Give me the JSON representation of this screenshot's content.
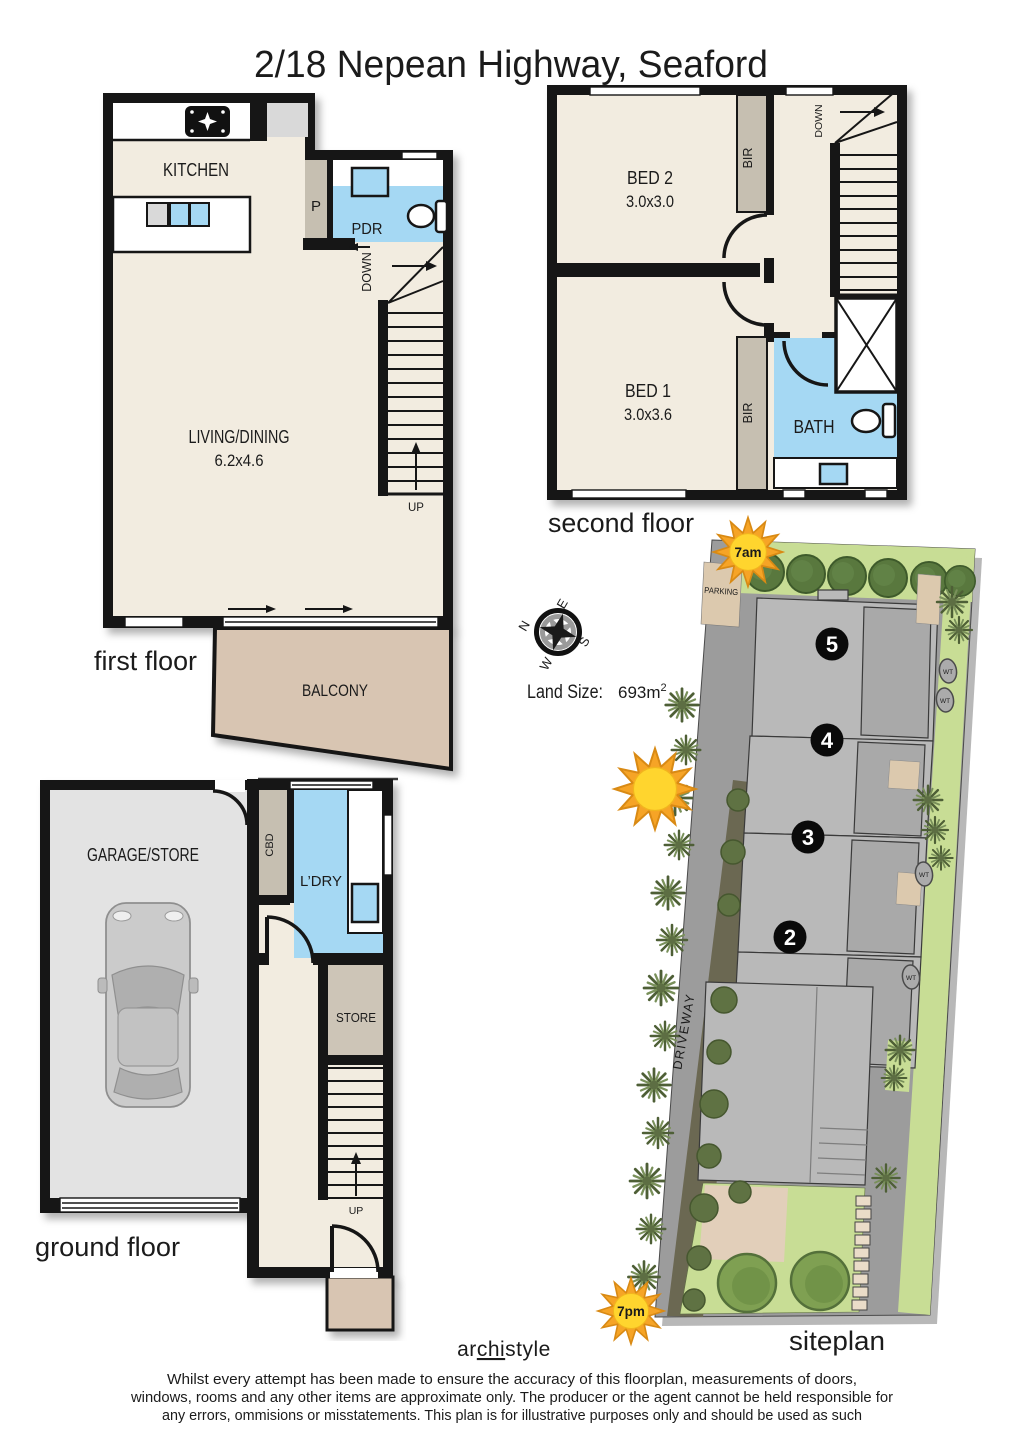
{
  "title": "2/18 Nepean Highway, Seaford",
  "floors": {
    "first": {
      "label": "first floor",
      "kitchen": "KITCHEN",
      "pantry": "P",
      "pdr": "PDR",
      "down": "DOWN",
      "up": "UP",
      "living": "LIVING/DINING",
      "living_dim": "6.2x4.6",
      "balcony": "BALCONY"
    },
    "second": {
      "label": "second floor",
      "bed2": "BED 2",
      "bed2_dim": "3.0x3.0",
      "bed1": "BED 1",
      "bed1_dim": "3.0x3.6",
      "bir": "BIR",
      "bath": "BATH",
      "down": "DOWN"
    },
    "ground": {
      "label": "ground floor",
      "garage": "GARAGE/STORE",
      "cbd": "CBD",
      "laundry": "L’DRY",
      "store": "STORE",
      "up": "UP"
    }
  },
  "siteplan": {
    "label": "siteplan",
    "parking": "PARKING",
    "driveway": "DRIVEWAY",
    "land_size_label": "Land Size:",
    "land_size_value": "693m",
    "land_size_sup": "2",
    "units": [
      "5",
      "4",
      "3",
      "2"
    ],
    "water_tank": "WT",
    "sun_morning": "7am",
    "sun_evening": "7pm",
    "compass": {
      "n": "N",
      "e": "E",
      "s": "S",
      "w": "W"
    }
  },
  "footer": {
    "logo_pre": "ar",
    "logo_mid": "chi",
    "logo_post": "style",
    "disclaimer1": "Whilst every attempt has been made to ensure the accuracy of this floorplan, measurements of doors,",
    "disclaimer2": "windows, rooms and any other items are approximate only. The producer or the agent cannot be held responsible for",
    "disclaimer3": "any errors, ommisions or misstatements. This plan is for illustrative purposes only and should be used as such"
  },
  "colors": {
    "wall": "#161616",
    "floor_cream": "#F2ECE0",
    "wet_blue": "#A5D8F3",
    "closet_grey": "#C6BFB1",
    "balcony_tan": "#D8C5B2",
    "garage_grey": "#E3E3E3",
    "store_grey": "#CDC5B7",
    "site_road": "#9C9C9C",
    "site_building": "#B9B9B9",
    "site_green": "#C8DD95",
    "tree_dark": "#59783E",
    "sun_orange": "#F6A426",
    "sun_yellow": "#FFD52E"
  }
}
